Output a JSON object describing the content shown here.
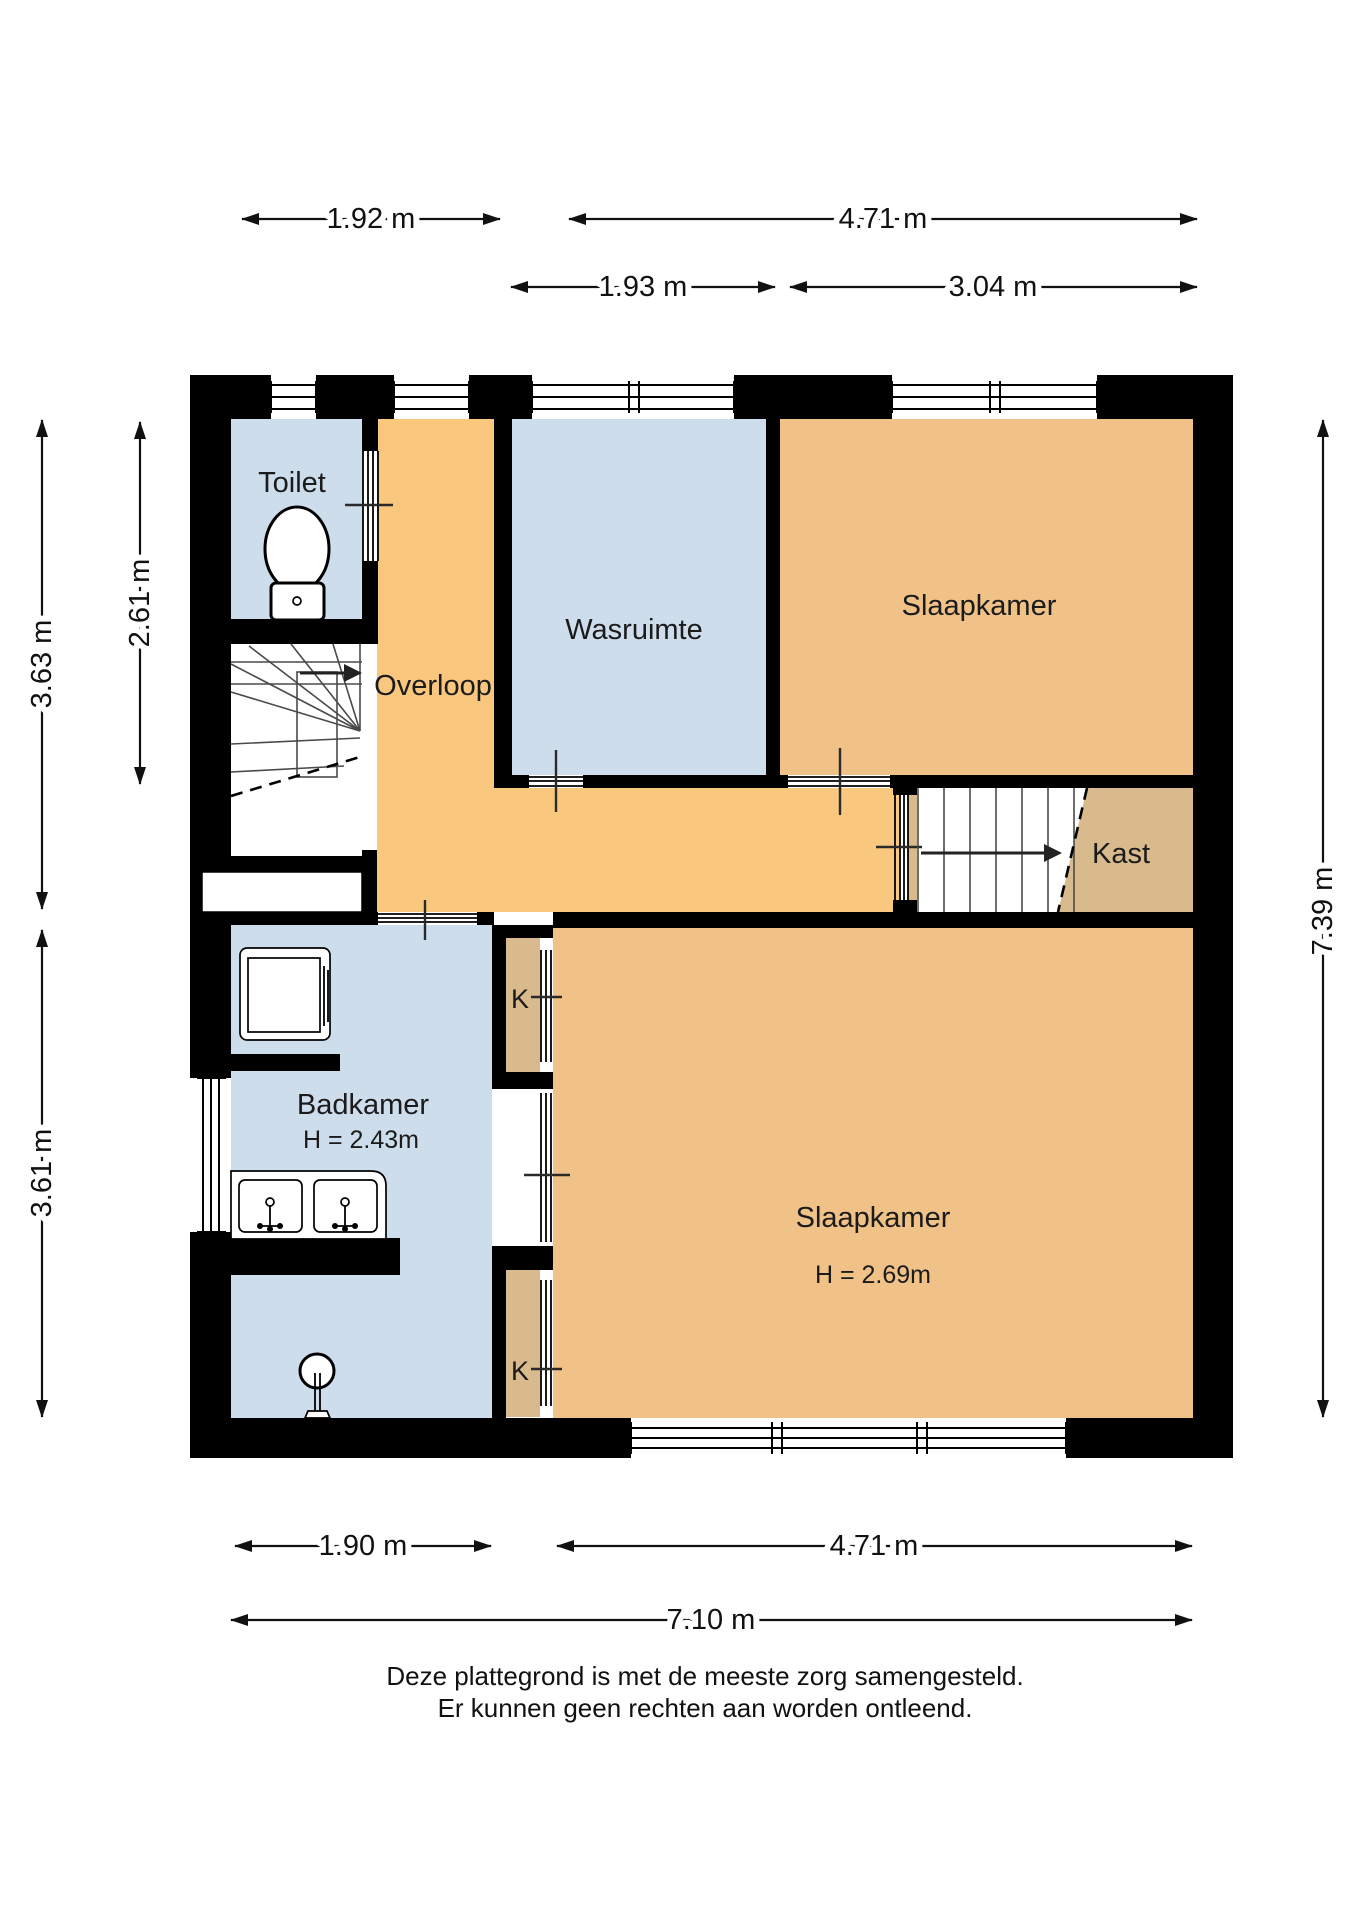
{
  "plan": {
    "type": "floorplan",
    "floor_note": "first floor (verdieping)"
  },
  "rooms": {
    "toilet": {
      "label": "Toilet"
    },
    "overloop": {
      "label": "Overloop"
    },
    "wasruimte": {
      "label": "Wasruimte"
    },
    "slaapkamer_boven": {
      "label": "Slaapkamer"
    },
    "kast": {
      "label": "Kast"
    },
    "badkamer": {
      "label": "Badkamer",
      "height": "H = 2.43m"
    },
    "slaapkamer_beneden": {
      "label": "Slaapkamer",
      "height": "H = 2.69m"
    },
    "kast_k_boven": {
      "label": "K"
    },
    "kast_k_onder": {
      "label": "K"
    }
  },
  "dims": {
    "top1a": "1.92 m",
    "top1b": "4.71 m",
    "top2a": "1.93 m",
    "top2b": "3.04 m",
    "left_upper": "3.63 m",
    "left_inner": "2.61 m",
    "left_lower": "3.61 m",
    "right": "7.39 m",
    "bottom1a": "1.90 m",
    "bottom1b": "4.71 m",
    "bottom2": "7.10 m"
  },
  "disclaimer": {
    "line1": "Deze plattegrond is met de meeste zorg samengesteld.",
    "line2": "Er kunnen geen rechten aan worden ontleend."
  },
  "colors": {
    "wall": "#000000",
    "room_blue": "#CEDDEB",
    "room_orange": "#F9C87E",
    "room_tan": "#F0C287",
    "closet_tan": "#D8BA8C"
  }
}
